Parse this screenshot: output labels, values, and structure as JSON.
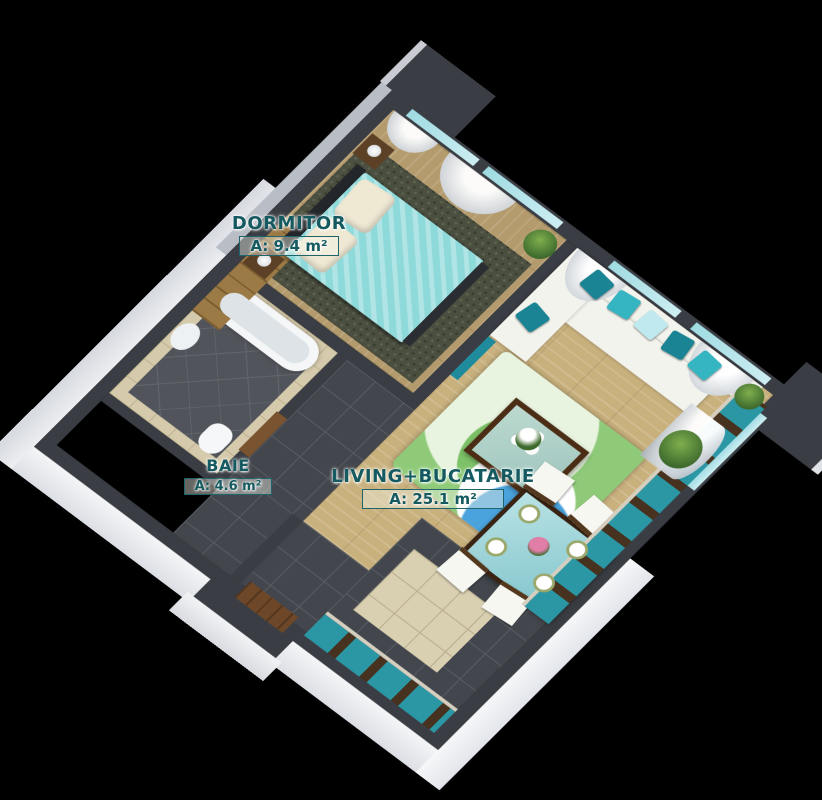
{
  "scene": {
    "background": "#000000",
    "description": "3D isometric cutaway floor plan render of a one-bedroom apartment"
  },
  "rooms": {
    "dormitor": {
      "name": "DORMITOR",
      "area": "A: 9.4 m²"
    },
    "baie": {
      "name": "BAIE",
      "area": "A: 4.6 m²"
    },
    "living": {
      "name": "LIVING+BUCATARIE",
      "area": "A: 25.1 m²"
    }
  },
  "colors": {
    "label_text": "#155a60",
    "wall_top": "#3a3e44",
    "wall_face_white": "#f0f1f4",
    "accent_teal": "#2b96a4",
    "bed_turquoise": "#8ed9da",
    "wood_floor": "#c9b17e",
    "rug_green": "#7cc168",
    "rug_blue": "#4aa3dc",
    "bath_tile": "#d5caab"
  }
}
